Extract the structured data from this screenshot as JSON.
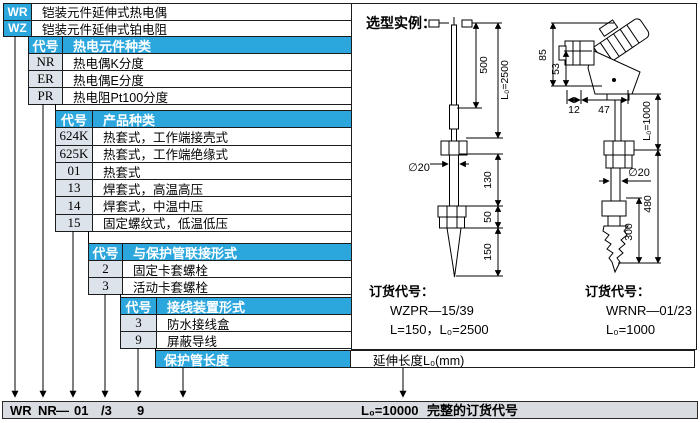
{
  "root_rows": [
    {
      "code": "WR",
      "desc": "铠装元件延伸式热电偶"
    },
    {
      "code": "WZ",
      "desc": "铠装元件延伸式铂电阻"
    }
  ],
  "tables": [
    {
      "code_header": "代号",
      "title": "热电元件种类",
      "rows": [
        {
          "code": "NR",
          "desc": "热电偶K分度"
        },
        {
          "code": "ER",
          "desc": "热电偶E分度"
        },
        {
          "code": "PR",
          "desc": "热电阻Pt100分度"
        }
      ]
    },
    {
      "code_header": "代号",
      "title": "产品种类",
      "rows": [
        {
          "code": "624K",
          "desc": "热套式，工作端接壳式"
        },
        {
          "code": "625K",
          "desc": "热套式，工作端绝缘式"
        },
        {
          "code": "01",
          "desc": "热套式"
        },
        {
          "code": "13",
          "desc": "焊套式，高温高压"
        },
        {
          "code": "14",
          "desc": "焊套式，中温中压"
        },
        {
          "code": "15",
          "desc": "固定螺纹式，低温低压"
        }
      ]
    },
    {
      "code_header": "代号",
      "title": "与保护管联接形式",
      "rows": [
        {
          "code": "2",
          "desc": "固定卡套螺栓"
        },
        {
          "code": "3",
          "desc": "活动卡套螺栓"
        }
      ]
    },
    {
      "code_header": "代号",
      "title": "接线装置形式",
      "rows": [
        {
          "code": "3",
          "desc": "防水接线盒"
        },
        {
          "code": "9",
          "desc": "屏蔽导线"
        }
      ]
    }
  ],
  "length_row": {
    "left": "保护管长度",
    "right": "延伸长度L₀(mm)"
  },
  "bottom_bar": {
    "codes": [
      "WR",
      "NR",
      "—",
      "01",
      "/3",
      "9"
    ],
    "length": "L₀=10000",
    "label": "完整的订货代号"
  },
  "panel": {
    "title": "选型实例：",
    "left_order": {
      "label": "订货代号：",
      "code": "WZPR—15/39",
      "line2": "L=150，L₀=2500"
    },
    "right_order": {
      "label": "订货代号：",
      "code": "WRNR—01/23",
      "line2": "L₀=1000"
    },
    "dims_left": {
      "d500": "500",
      "l0": "L₀=2500",
      "dia": "∅20",
      "d130": "130",
      "d50": "50",
      "d150": "150"
    },
    "dims_right": {
      "d85": "85",
      "d53": "53",
      "d12": "12",
      "d47": "47",
      "dia": "∅20",
      "l0": "L₀=1000",
      "d480": "480",
      "d300": "300"
    }
  },
  "colors": {
    "header_blue": "#2ca7dd",
    "code_grey": "#dce3ea",
    "bar_grey": "#d9dde1"
  }
}
